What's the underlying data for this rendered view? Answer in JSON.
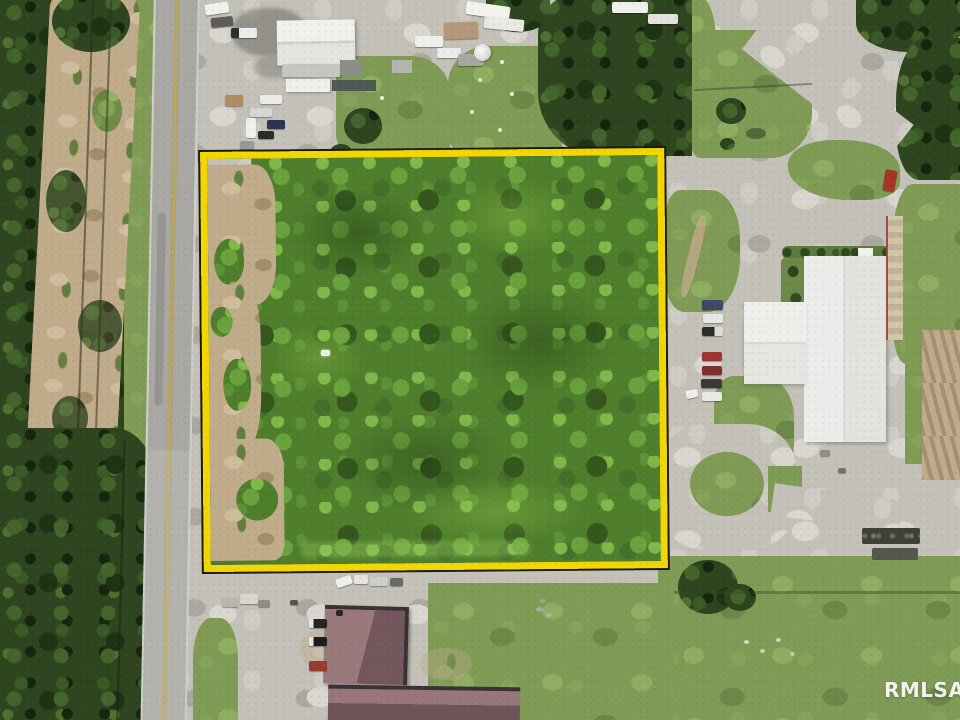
{
  "watermark": {
    "label": "RMLSA"
  },
  "boundary": {
    "stroke": "#f2d703",
    "outline": "#1c1a06"
  },
  "palette": {
    "forest_dark": "#2e451f",
    "canopy_green": "#4f7e2c",
    "grass_green": "#7f9b55",
    "gravel_gray": "#c3c1b8",
    "dirt_tan": "#c0ab8a",
    "road_gray": "#a9a8a4",
    "roof_white": "#e9e9e6",
    "roof_mauve": "#8b6a6e",
    "car_red": "#a63428"
  }
}
